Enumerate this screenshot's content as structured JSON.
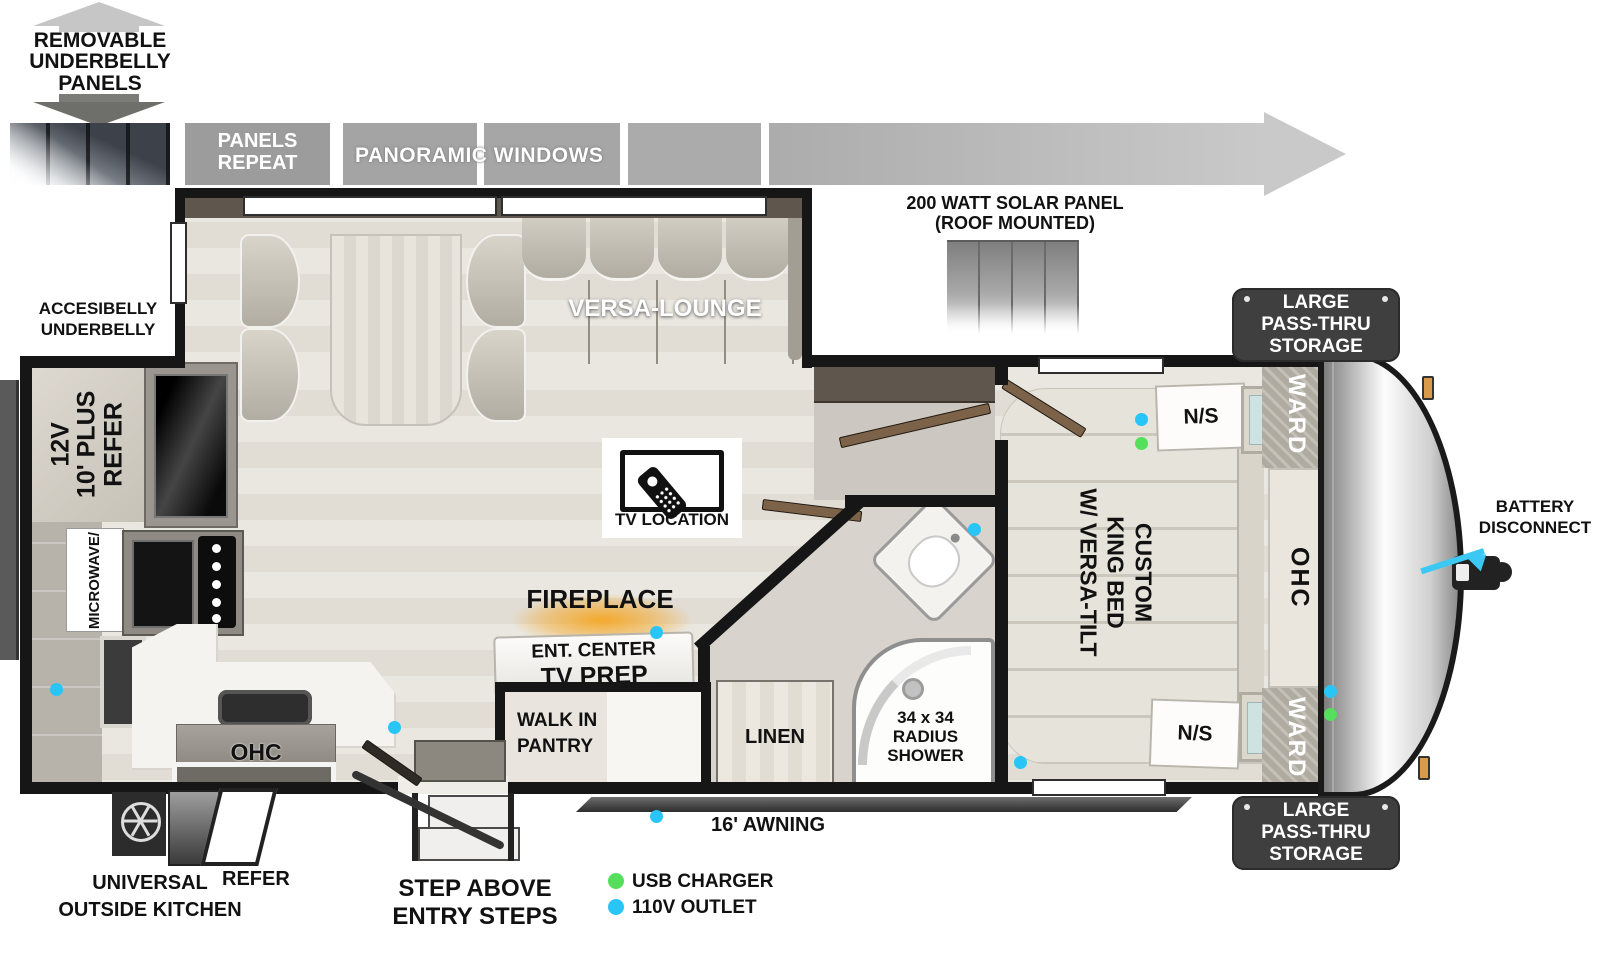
{
  "colors": {
    "outlet_blue": "#29C5F6",
    "usb_green": "#55DF5C",
    "battery_arrow_cyan": "#3BC9F3",
    "fireplace_glow_orange": "#F5A623"
  },
  "top": {
    "underbelly_arrow": [
      "REMOVABLE",
      "UNDERBELLY",
      "PANELS"
    ],
    "panels_repeat": [
      "PANELS",
      "REPEAT"
    ],
    "panoramic_windows": "PANORAMIC WINDOWS",
    "solar": [
      "200 WATT SOLAR PANEL",
      "(ROOF MOUNTED)"
    ]
  },
  "exterior": {
    "accesibelly": [
      "ACCESIBELLY",
      "UNDERBELLY"
    ],
    "battery": [
      "BATTERY",
      "DISCONNECT"
    ],
    "storage_top": [
      "LARGE",
      "PASS-THRU",
      "STORAGE"
    ],
    "storage_bottom": [
      "LARGE",
      "PASS-THRU",
      "STORAGE"
    ],
    "awning": "16' AWNING",
    "outside_kitchen": [
      "UNIVERSAL",
      "OUTSIDE KITCHEN"
    ],
    "outside_refer": "REFER",
    "steps": [
      "STEP ABOVE",
      "ENTRY STEPS"
    ]
  },
  "interior": {
    "versa_lounge": "VERSA-LOUNGE",
    "tv_location": "TV LOCATION",
    "fireplace": "FIREPLACE",
    "ent_center": "ENT. CENTER",
    "tv_prep": "TV PREP",
    "pantry": [
      "WALK IN",
      "PANTRY"
    ],
    "linen": "LINEN",
    "shower": [
      "34 x 34",
      "RADIUS",
      "SHOWER"
    ],
    "refer": [
      "12V",
      "10' PLUS",
      "REFER"
    ],
    "microwave": "MICROWAVE/",
    "kitchen_ohc": "OHC",
    "bed": [
      "CUSTOM",
      "KING BED",
      "W/ VERSA-TILT"
    ],
    "ns_top": "N/S",
    "ns_bottom": "N/S",
    "ward_top": "WARD",
    "ward_bottom": "WARD",
    "bedroom_ohc": "OHC"
  },
  "legend": [
    {
      "label": "USB CHARGER",
      "color": "#55DF5C"
    },
    {
      "label": "110V OUTLET",
      "color": "#29C5F6"
    }
  ]
}
